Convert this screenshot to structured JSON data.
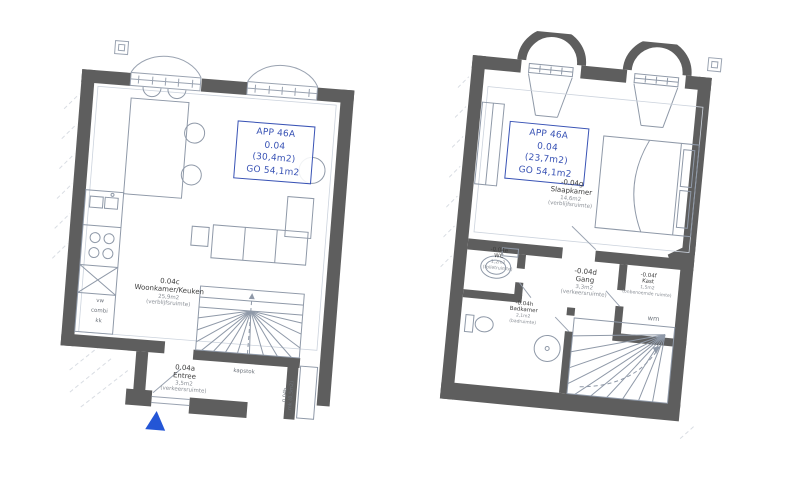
{
  "plans": {
    "ground": {
      "app_box": {
        "l1": "APP 46A",
        "l2": "0.04",
        "l3": "(30,4m2)",
        "l4": "GO 54,1m2"
      },
      "woonkamer": {
        "code": "0.04c",
        "name": "Woonkamer/Keuken",
        "area": "25,9m2",
        "type": "(verblijfsruimte)"
      },
      "entree": {
        "code": "0.04a",
        "name": "Entree",
        "area": "3,5m2",
        "type": "(verkeersruimte)"
      },
      "kapstok": "kapstok",
      "mk_code": "0.04b",
      "mk_label": "mk (0,5m2)",
      "vw": "vw",
      "combi": "combi",
      "kk": "kk"
    },
    "upper": {
      "app_box": {
        "l1": "APP 46A",
        "l2": "0.04",
        "l3": "(23,7m2)",
        "l4": "GO 54,1m2"
      },
      "slaapkamer": {
        "code": "-0.04g",
        "name": "Slaapkamer",
        "area": "14,6m2",
        "type": "(verblijfsruimte)"
      },
      "wc": {
        "code": "-0.04e",
        "name": "WC",
        "area": "1,2m2",
        "type": "(toiletruimte)"
      },
      "gang": {
        "code": "-0.04d",
        "name": "Gang",
        "area": "3,3m2",
        "type": "(verkeersruimte)"
      },
      "kast": {
        "code": "-0.04f",
        "name": "Kast",
        "area": "1,5m2",
        "type": "(onbenoemde ruimte)"
      },
      "badkamer": {
        "code": "-0.04h",
        "name": "Badkamer",
        "area": "2,1m2",
        "type": "(badruimte)"
      },
      "wm": "wm"
    }
  },
  "colors": {
    "wall": "#5e5e5e",
    "accent_blue": "#3953b5",
    "arrow_blue": "#2456d6",
    "line": "#8f99a8"
  }
}
